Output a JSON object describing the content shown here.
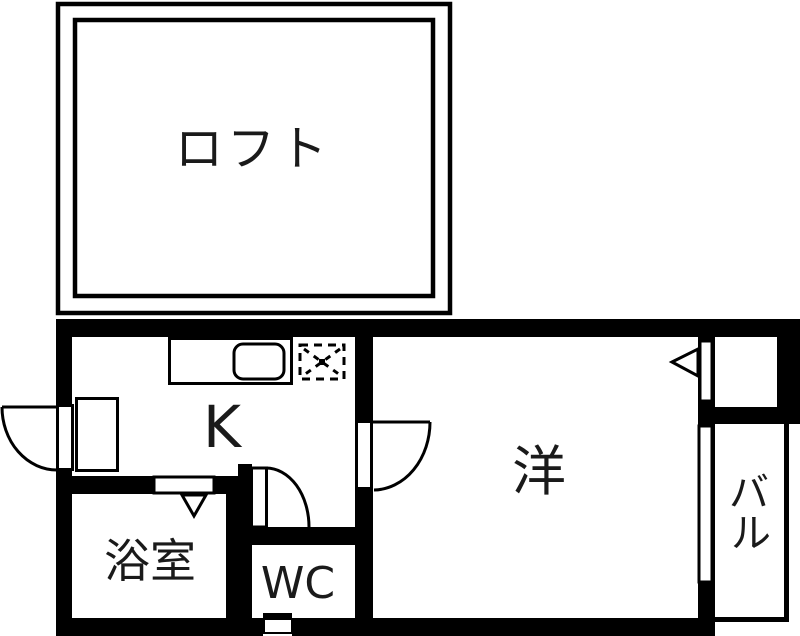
{
  "plan": {
    "colors": {
      "wall": "#000000",
      "floor": "#ffffff",
      "text": "#1a1a1a"
    },
    "rooms": {
      "loft": {
        "label": "ロフト"
      },
      "kitchen": {
        "label": "K"
      },
      "bathroom": {
        "label": "浴室"
      },
      "toilet": {
        "label": "WC"
      },
      "western": {
        "label": "洋"
      },
      "balcony": {
        "label": "バル",
        "chars": [
          "バ",
          "ル"
        ]
      }
    }
  }
}
